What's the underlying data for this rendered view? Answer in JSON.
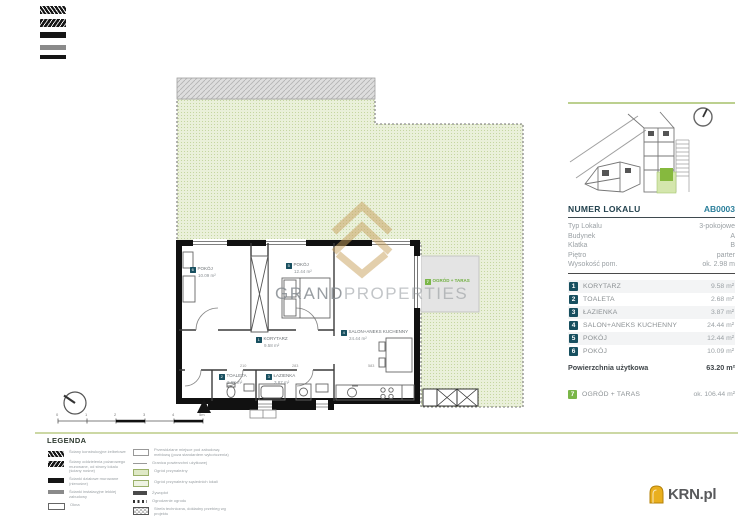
{
  "watermark": {
    "word1": "GRAND",
    "word2": "PROPERTIES"
  },
  "logo": {
    "text": "KRN.pl"
  },
  "unit": {
    "header_label": "NUMER LOKALU",
    "header_value": "AB0003"
  },
  "details": {
    "rows": [
      {
        "label": "Typ Lokalu",
        "value": "3-pokojowe"
      },
      {
        "label": "Budynek",
        "value": "A"
      },
      {
        "label": "Klatka",
        "value": "B"
      },
      {
        "label": "Piętro",
        "value": "parter"
      },
      {
        "label": "Wysokość pom.",
        "value": "ok. 2.98 m"
      }
    ]
  },
  "rooms": [
    {
      "num": "1",
      "name": "KORYTARZ",
      "area": "9.58 m²"
    },
    {
      "num": "2",
      "name": "TOALETA",
      "area": "2.68 m²"
    },
    {
      "num": "3",
      "name": "ŁAZIENKA",
      "area": "3.87 m²"
    },
    {
      "num": "4",
      "name": "SALON+ANEKS KUCHENNY",
      "area": "24.44 m²"
    },
    {
      "num": "5",
      "name": "POKÓJ",
      "area": "12.44 m²"
    },
    {
      "num": "6",
      "name": "POKÓJ",
      "area": "10.09 m²"
    }
  ],
  "total": {
    "label": "Powierzchnia użytkowa",
    "value": "63.20 m²"
  },
  "outdoor": {
    "num": "7",
    "name": "OGRÓD + TARAS",
    "area": "ok. 106.44 m²"
  },
  "plan": {
    "dims": [
      "210",
      "283",
      "583"
    ],
    "scale_ticks": [
      "0",
      "1",
      "2",
      "3",
      "4",
      "5m"
    ]
  },
  "legend": {
    "title": "LEGENDA",
    "left": [
      {
        "text": "Ściany konstrukcyjne żelbetowe"
      },
      {
        "text": "Ściany oddzielenia pożarowego murowane, od strony lokalu (ściany nośne)"
      },
      {
        "text": "Ścianki działowe murowane (nienośne)"
      },
      {
        "text": "Ścianki instalacyjne lekkiej zabudowy"
      },
      {
        "text": "Okna"
      }
    ],
    "right": [
      {
        "text": "Przewidziane miejsce pod zabudowę meblową (poza standardem wykończenia)"
      },
      {
        "text": "Granica powierzchni użytkowej"
      },
      {
        "text": "Ogród przynależny"
      },
      {
        "text": "Ogród przynależny sąsiednich lokali"
      },
      {
        "text": "Żywopłot"
      },
      {
        "text": "Ogrodzenie ogrodu"
      },
      {
        "text": "Strefa techniczna, dokładny przebieg wg projektu"
      }
    ]
  },
  "colors": {
    "accent_teal": "#174f5f",
    "accent_green": "#7ab648",
    "garden": "#eaf0da",
    "gold": "#c8a05c"
  }
}
